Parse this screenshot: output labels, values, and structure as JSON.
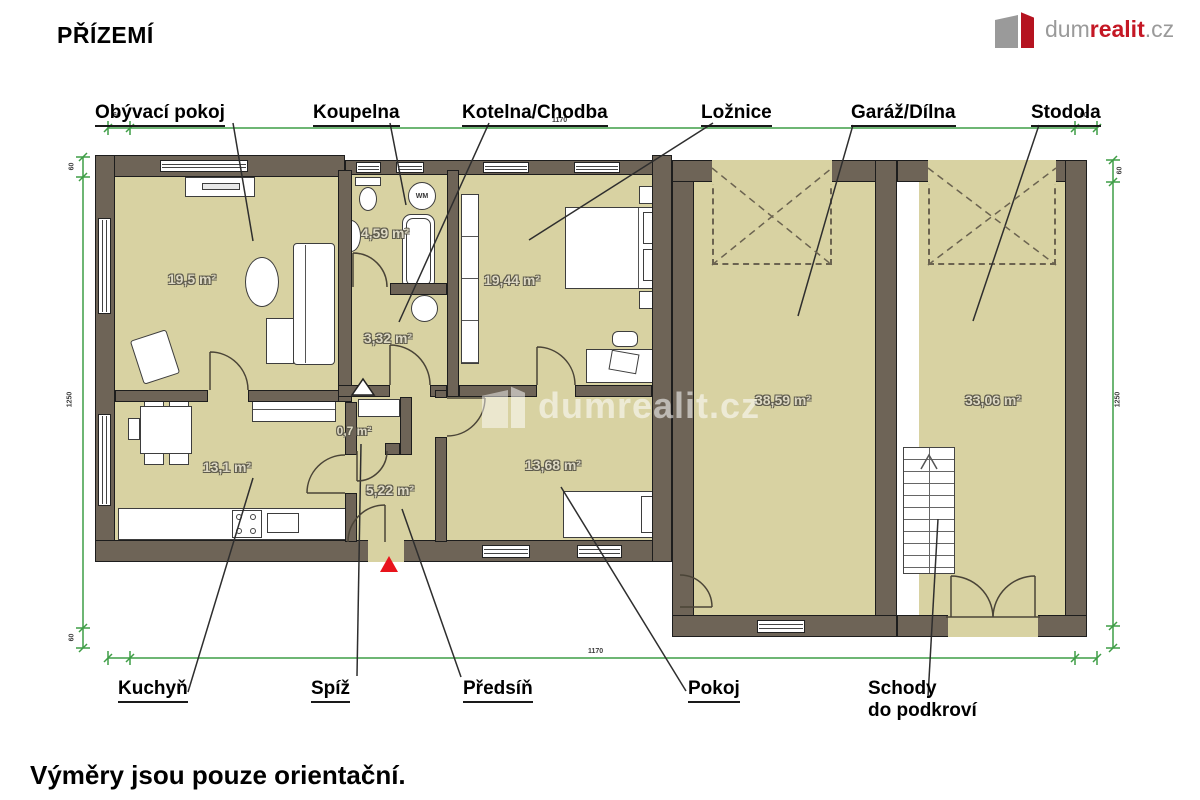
{
  "header": {
    "title": "PŘÍZEMÍ"
  },
  "logo": {
    "prefix": "dum",
    "accent": "realit",
    "suffix": ".cz"
  },
  "watermark": {
    "text": "dumrealit.cz"
  },
  "footer": {
    "note": "Výměry jsou pouze orientační."
  },
  "rooms": [
    {
      "name": "Obývací pokoj",
      "area": "19,5 m²"
    },
    {
      "name": "Koupelna",
      "area": "4,59 m²"
    },
    {
      "name": "Kotelna/Chodba",
      "area": "3,32 m²"
    },
    {
      "name": "Ložnice",
      "area": "19,44 m²"
    },
    {
      "name": "Garáž/Dílna",
      "area": "38,59 m²"
    },
    {
      "name": "Stodola",
      "area": "33,06 m²"
    },
    {
      "name": "Kuchyň",
      "area": "13,1 m²"
    },
    {
      "name": "Spíž",
      "area": "0,7 m²"
    },
    {
      "name": "Předsíň",
      "area": "5,22 m²"
    },
    {
      "name": "Pokoj",
      "area": "13,68 m²"
    },
    {
      "name": "Schody do podkroví",
      "area": ""
    }
  ],
  "labels": {
    "schody1": "Schody",
    "schody2": "do podkroví"
  },
  "appliances": {
    "washing_machine": "WM"
  },
  "dimensions": {
    "wall_tick": "60",
    "top_span": "1170",
    "bottom_span": "1170",
    "side_span": "1250"
  },
  "colors": {
    "wall": "#6e6457",
    "floor": "#d8d2a2",
    "dimension_line": "#3f9d46",
    "brand_red": "#c41724",
    "entrance_marker": "#e8131b"
  }
}
